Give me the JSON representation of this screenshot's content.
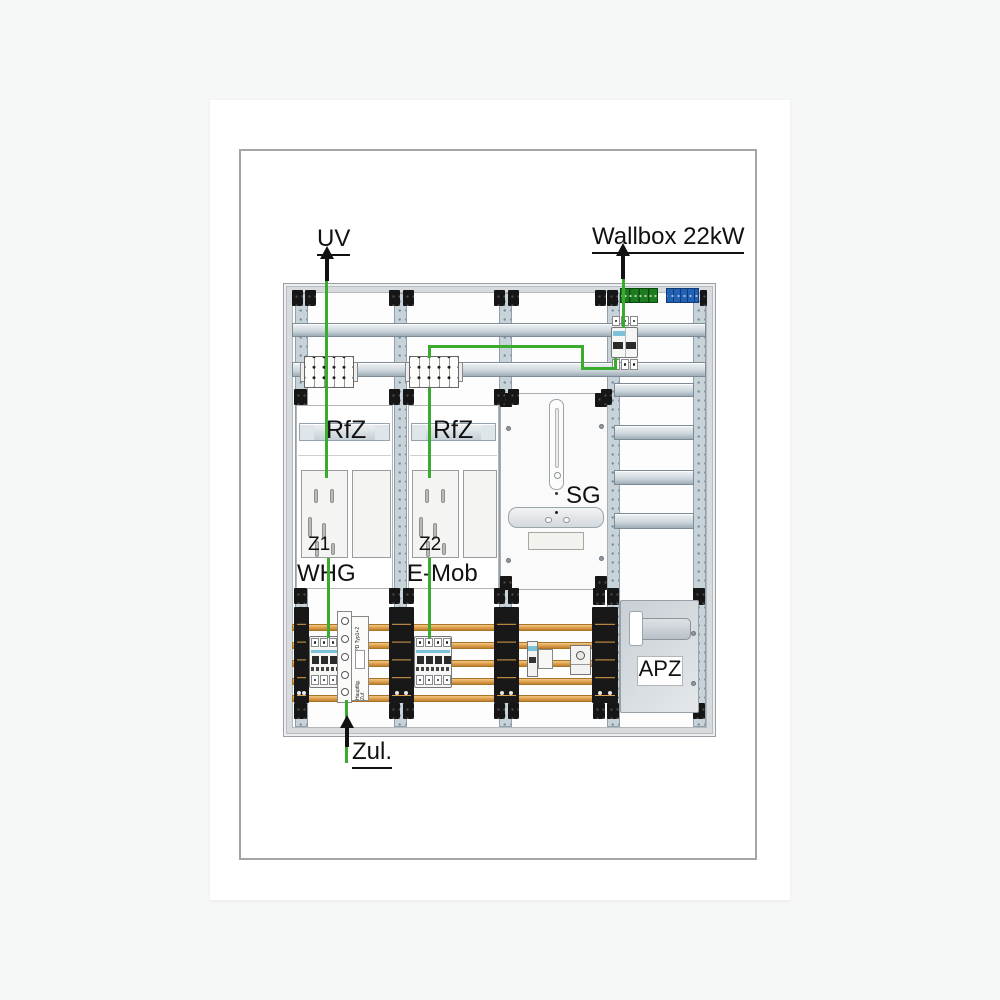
{
  "sheet": {
    "background": "#f6f7f7",
    "paper": "#ffffff",
    "border_color": "#a5a5a5"
  },
  "diagram": {
    "external_labels": {
      "top_left": "UV",
      "top_right": "Wallbox 22kW",
      "bottom": "Zul."
    },
    "fields": [
      {
        "rail_label": "RfZ",
        "meter_label": "Z1",
        "circuit_label": "WHG"
      },
      {
        "rail_label": "RfZ",
        "meter_label": "Z2",
        "circuit_label": "E-Mob"
      }
    ],
    "panels": {
      "control_panel": "SG",
      "apz_panel": "APZ"
    },
    "feed_terminal": {
      "label_top": "SPD Typ1+2",
      "label_bottom": "Hauptltg. Zuf."
    },
    "colors": {
      "wire_green": "#3aab2e",
      "busbar_orange": "#e2a551",
      "terminal_green": "#1d7c1f",
      "terminal_blue": "#2261b4",
      "frame_gray": "#d8dbde",
      "rail_gray": "#c8d2d9",
      "arrow_black": "#111111"
    }
  }
}
